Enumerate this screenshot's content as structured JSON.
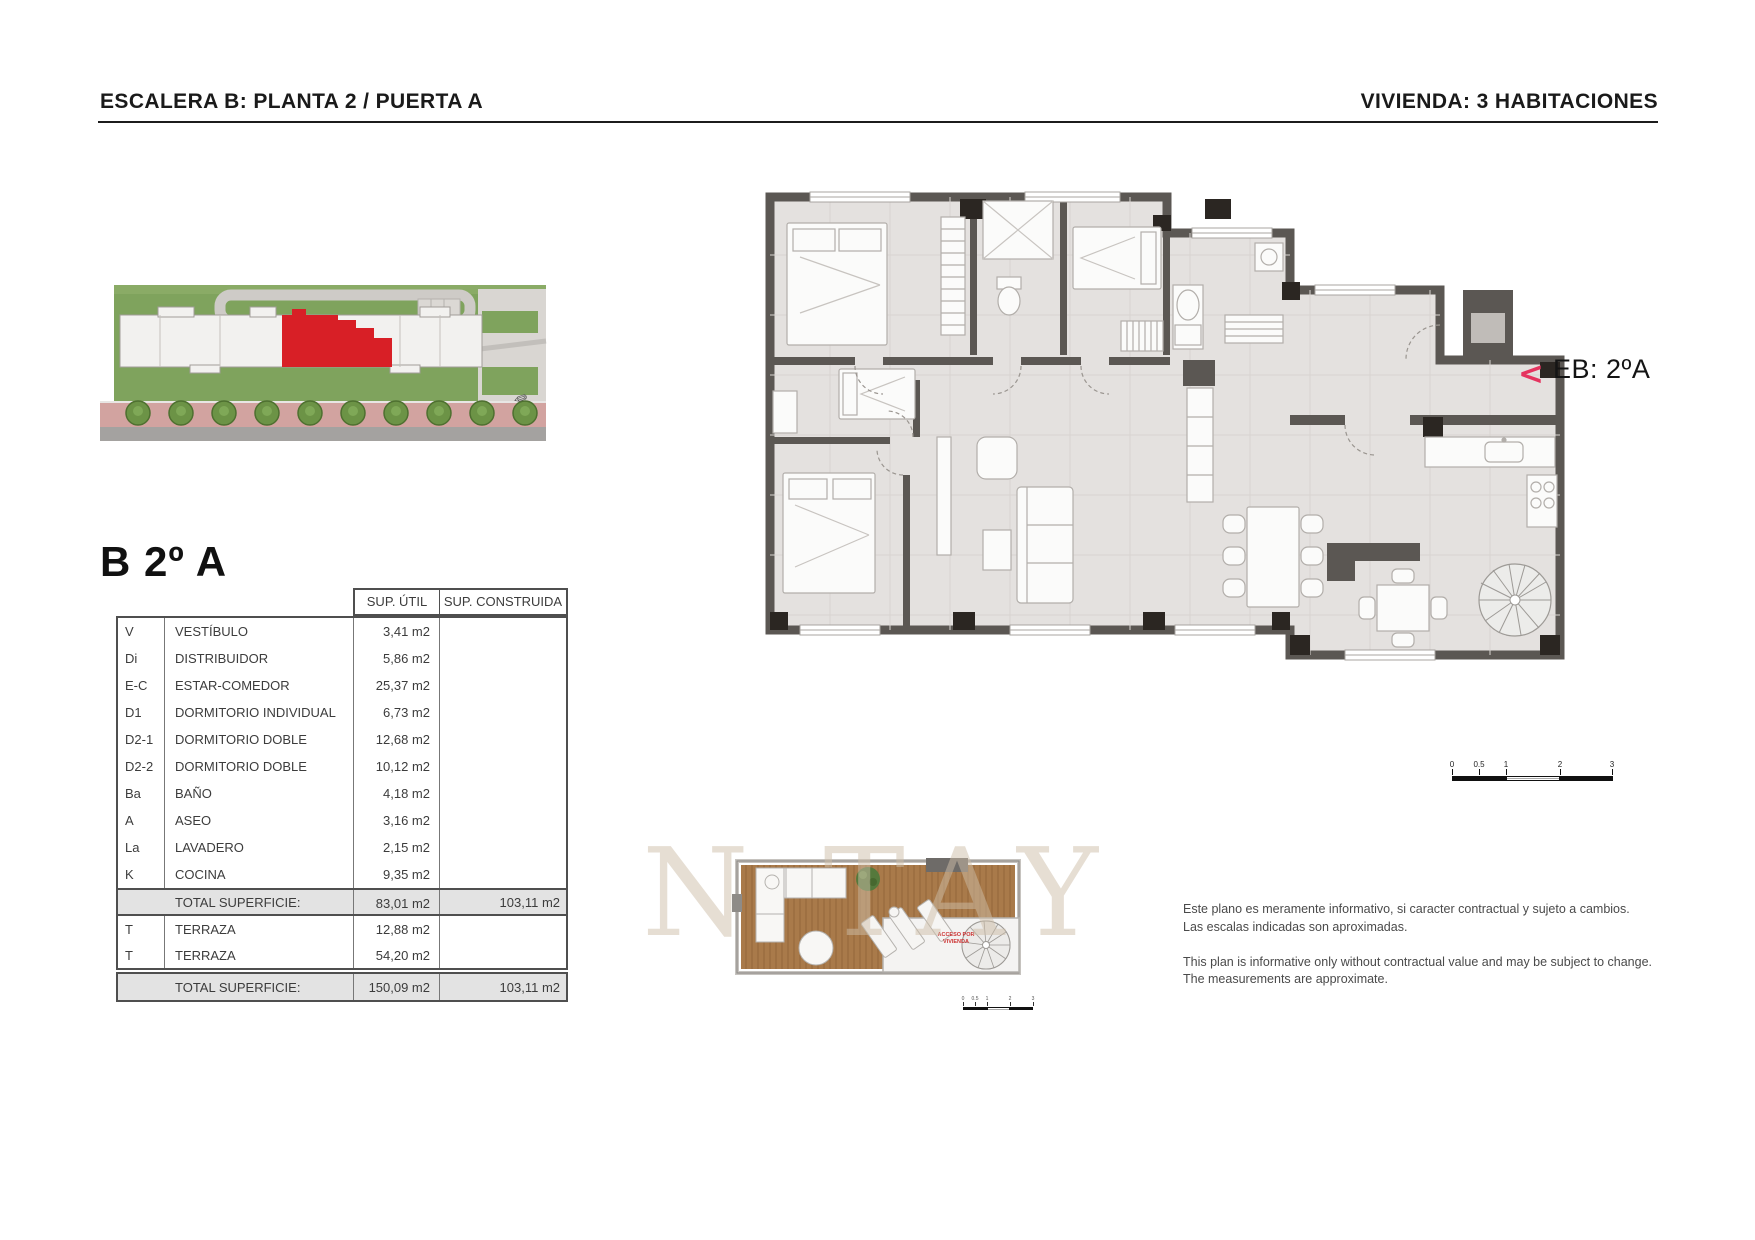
{
  "page": {
    "header_left": "ESCALERA B: PLANTA 2 / PUERTA A",
    "header_right": "VIVIENDA: 3 HABITACIONES",
    "unit_title": "B 2º A",
    "accent_color": "#e5345f",
    "highlight_color": "#d81f26",
    "watermark": "N TAY"
  },
  "eb_marker": {
    "chevron": "<",
    "label": "EB: 2ºA"
  },
  "surface_table": {
    "col_headers": {
      "util": "SUP. ÚTIL",
      "construida": "SUP. CONSTRUIDA"
    },
    "rows": [
      {
        "code": "V",
        "name": "VESTÍBULO",
        "util": "3,41 m2",
        "cons": ""
      },
      {
        "code": "Di",
        "name": "DISTRIBUIDOR",
        "util": "5,86 m2",
        "cons": ""
      },
      {
        "code": "E-C",
        "name": "ESTAR-COMEDOR",
        "util": "25,37 m2",
        "cons": ""
      },
      {
        "code": "D1",
        "name": "DORMITORIO INDIVIDUAL",
        "util": "6,73 m2",
        "cons": ""
      },
      {
        "code": "D2-1",
        "name": "DORMITORIO DOBLE",
        "util": "12,68 m2",
        "cons": ""
      },
      {
        "code": "D2-2",
        "name": "DORMITORIO DOBLE",
        "util": "10,12 m2",
        "cons": ""
      },
      {
        "code": "Ba",
        "name": "BAÑO",
        "util": "4,18 m2",
        "cons": ""
      },
      {
        "code": "A",
        "name": "ASEO",
        "util": "3,16 m2",
        "cons": ""
      },
      {
        "code": "La",
        "name": "LAVADERO",
        "util": "2,15 m2",
        "cons": ""
      },
      {
        "code": "K",
        "name": "COCINA",
        "util": "9,35 m2",
        "cons": ""
      }
    ],
    "total_1": {
      "label": "TOTAL SUPERFICIE:",
      "util": "83,01 m2",
      "cons": "103,11 m2"
    },
    "terrace_rows": [
      {
        "code": "T",
        "name": "TERRAZA",
        "util": "12,88 m2",
        "cons": ""
      },
      {
        "code": "T",
        "name": "TERRAZA",
        "util": "54,20 m2",
        "cons": ""
      }
    ],
    "total_2": {
      "label": "TOTAL SUPERFICIE:",
      "util": "150,09 m2",
      "cons": "103,11 m2"
    }
  },
  "terrace_plan": {
    "access_line1": "ACCESO POR",
    "access_line2": "VIVIENDA"
  },
  "scale_bar": {
    "labels": [
      "0",
      "0.5",
      "1",
      "2",
      "3"
    ]
  },
  "disclaimer": {
    "es_line1": "Este plano es meramente informativo, si caracter contractual y sujeto a cambios.",
    "es_line2": "Las escalas indicadas son aproximadas.",
    "en_line1": "This plan is informative only without contractual value and may be subject to change.",
    "en_line2": "The measurements are approximate."
  }
}
